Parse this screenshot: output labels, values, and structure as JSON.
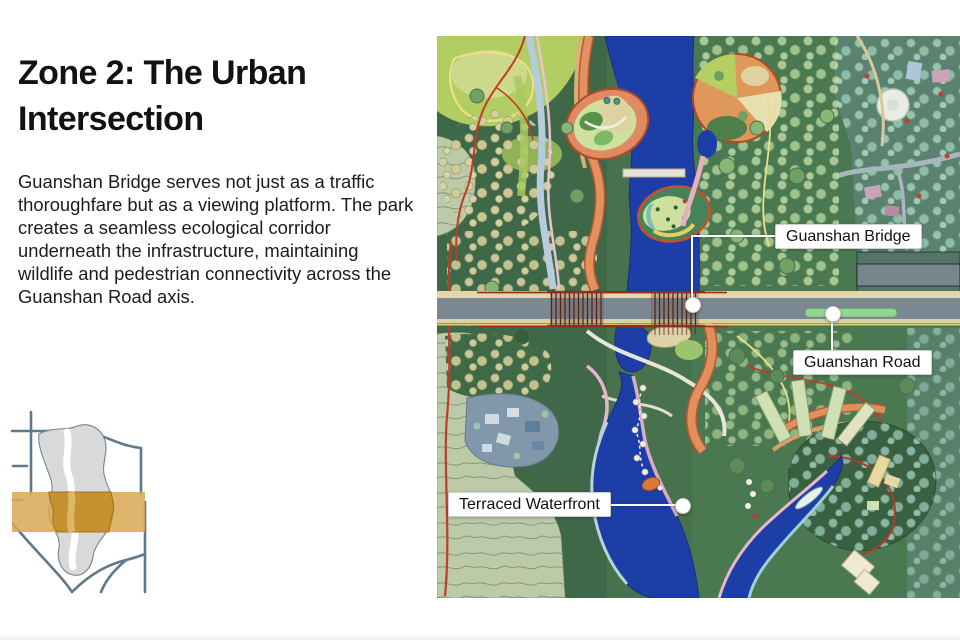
{
  "slide": {
    "title": "Zone 2: The Urban Intersection",
    "body": "Guanshan Bridge serves not just as a traffic thoroughfare but as a viewing platform. The park creates a seamless ecological corridor underneath the infrastructure, maintaining wildlife and pedestrian connectivity across the Guanshan Road axis."
  },
  "map": {
    "callouts": [
      {
        "id": "guanshan-bridge",
        "label": "Guanshan Bridge"
      },
      {
        "id": "guanshan-road",
        "label": "Guanshan Road"
      },
      {
        "id": "terraced-waterfront",
        "label": "Terraced Waterfront"
      }
    ]
  },
  "minimap": {
    "zone_highlight_color": "#C8943B"
  },
  "colors": {
    "water": "#1D3EA7",
    "road_asphalt": "#7B8894",
    "zone_highlight": "#C8943B"
  }
}
